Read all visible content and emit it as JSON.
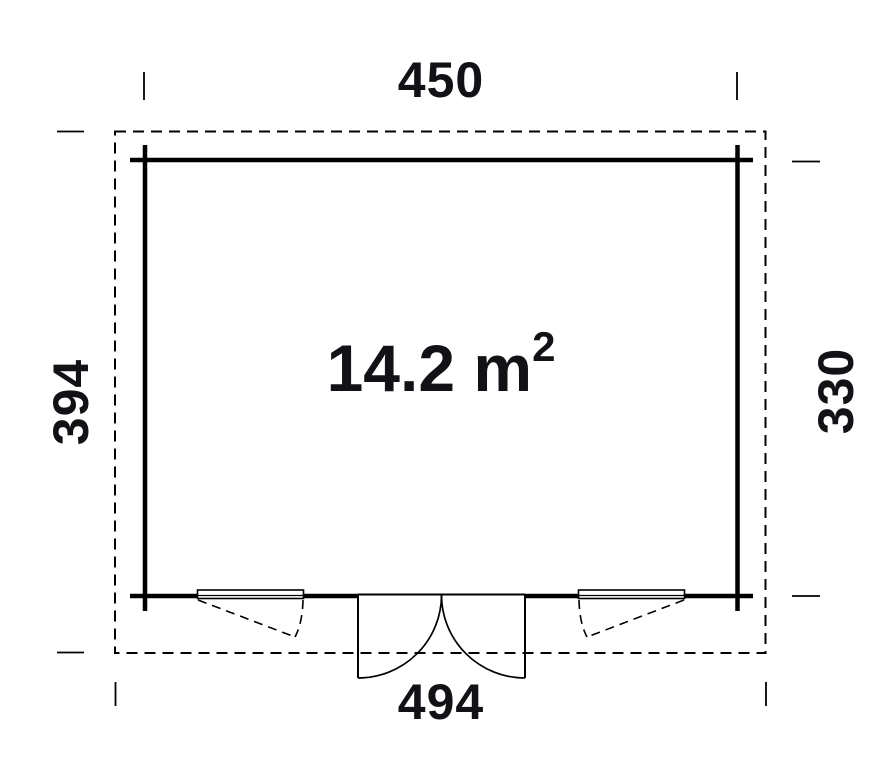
{
  "plan": {
    "title": "garden-house-floor-plan",
    "area": {
      "main": "14.2 m",
      "sup": "2"
    },
    "dimensions": {
      "top": "450",
      "bottom": "494",
      "left": "394",
      "right": "330"
    }
  },
  "colors": {
    "line": "#000000",
    "background": "#ffffff",
    "text": "#121216"
  }
}
